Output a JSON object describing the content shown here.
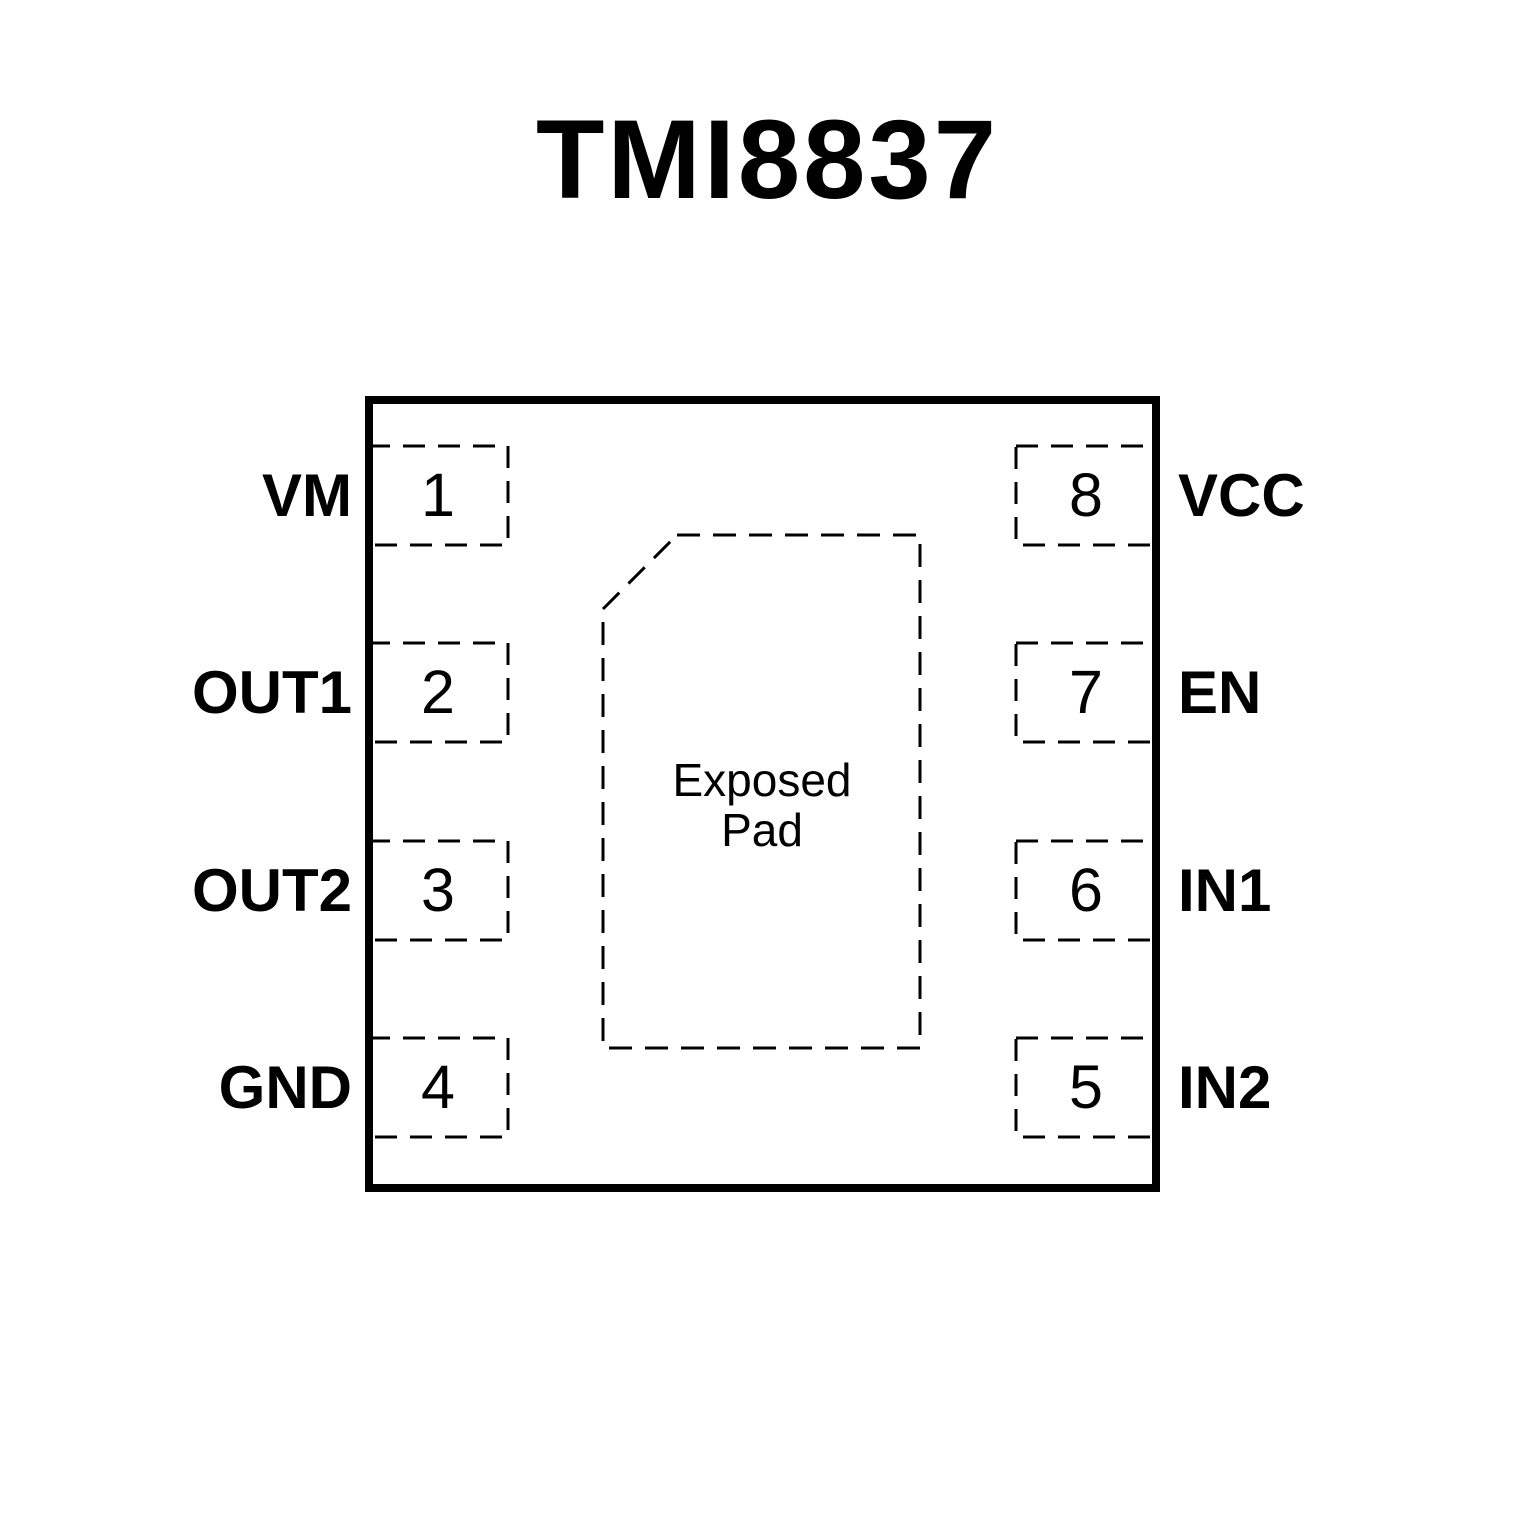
{
  "title": "TMI8837",
  "exposed_pad": {
    "line1": "Exposed",
    "line2": "Pad"
  },
  "pins": {
    "left": [
      {
        "number": "1",
        "name": "VM"
      },
      {
        "number": "2",
        "name": "OUT1"
      },
      {
        "number": "3",
        "name": "OUT2"
      },
      {
        "number": "4",
        "name": "GND"
      }
    ],
    "right": [
      {
        "number": "8",
        "name": "VCC"
      },
      {
        "number": "7",
        "name": "EN"
      },
      {
        "number": "6",
        "name": "IN1"
      },
      {
        "number": "5",
        "name": "IN2"
      }
    ]
  },
  "colors": {
    "line": "#000000",
    "background": "#ffffff",
    "text": "#000000"
  }
}
